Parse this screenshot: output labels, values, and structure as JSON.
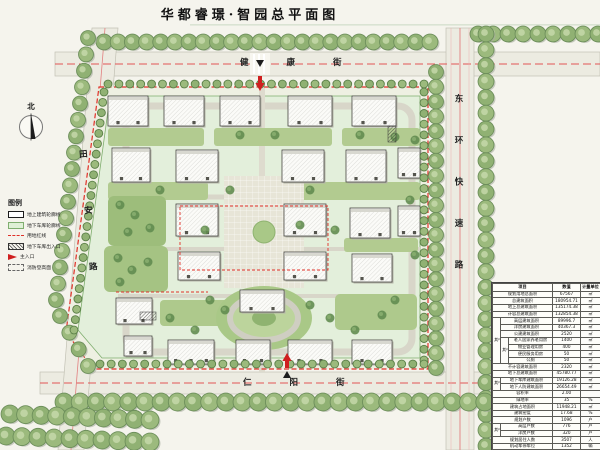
{
  "title": "华都睿璟·智园总平面图",
  "north_arrow_label": "北",
  "streets": {
    "north": "健康街",
    "south": "仁阳街",
    "west": "田安路",
    "east": "东环快速路"
  },
  "colors": {
    "boundary_red": "#e03028",
    "garage_green": "#dff0d6",
    "tree_green": "#9cba7d",
    "road_gray": "#ecebe1"
  },
  "legend": {
    "title": "图例",
    "items": [
      {
        "symbol": "building-outline",
        "label": "地上建筑轮廓线"
      },
      {
        "symbol": "garage-outline",
        "label": "地下车库轮廓线"
      },
      {
        "symbol": "red-line",
        "label": "用地红线"
      },
      {
        "symbol": "garage-entrance",
        "label": "地下车库出入口"
      },
      {
        "symbol": "main-entrance",
        "label": "主入口"
      },
      {
        "symbol": "fire-area",
        "label": "消防登高面"
      }
    ]
  },
  "table": {
    "headers": [
      "项目",
      "数值",
      "计量单位"
    ],
    "rows": [
      {
        "label": "规划用地总面积",
        "value": "67567",
        "unit": "㎡"
      },
      {
        "label": "总建筑面积",
        "value": "180954.71",
        "unit": "㎡"
      },
      {
        "label": "地上总建筑面积",
        "value": "135174.38",
        "unit": "㎡"
      },
      {
        "label": "计容总建筑面积",
        "value": "132854.38",
        "unit": "㎡"
      },
      {
        "group": "其中",
        "label": "高层建筑面积",
        "value": "89996.7",
        "unit": "㎡"
      },
      {
        "group": "其中",
        "label": "洋房建筑面积",
        "value": "40367.3",
        "unit": "㎡"
      },
      {
        "group": "其中",
        "label": "公建建筑面积",
        "value": "2520",
        "unit": "㎡"
      },
      {
        "group": "其中",
        "group2": "其中",
        "label": "老人居家养老用房",
        "value": "1400",
        "unit": "㎡"
      },
      {
        "group": "其中",
        "group2": "其中",
        "label": "物业管理用房",
        "value": "400",
        "unit": "㎡"
      },
      {
        "group": "其中",
        "group2": "其中",
        "label": "便民服务用房",
        "value": "50",
        "unit": "㎡"
      },
      {
        "group": "其中",
        "group2": "其中",
        "label": "公厕",
        "value": "50",
        "unit": "㎡"
      },
      {
        "label": "不计容建筑面积",
        "value": "2320",
        "unit": "㎡"
      },
      {
        "label": "地下总建筑面积",
        "value": "45780.77",
        "unit": "㎡"
      },
      {
        "group": "其中",
        "label": "地下车库建筑面积",
        "value": "19126.28",
        "unit": "㎡"
      },
      {
        "group": "其中",
        "label": "地下人防建筑面积",
        "value": "26654.49",
        "unit": "㎡"
      },
      {
        "label": "容积率",
        "value": "2.00",
        "unit": ""
      },
      {
        "label": "绿地率",
        "value": "35",
        "unit": "%"
      },
      {
        "label": "建筑占地面积",
        "value": "11948.21",
        "unit": "㎡"
      },
      {
        "label": "建筑密度",
        "value": "17.68",
        "unit": "%"
      },
      {
        "label": "规划户数",
        "value": "1096",
        "unit": "户"
      },
      {
        "group": "其中",
        "label": "高层户数",
        "value": "776",
        "unit": "户"
      },
      {
        "group": "其中",
        "label": "洋房户数",
        "value": "320",
        "unit": "户"
      },
      {
        "label": "规划居住人数",
        "value": "3507",
        "unit": "人"
      },
      {
        "label": "机动车停车位",
        "value": "1352",
        "unit": "辆"
      },
      {
        "label": "非机动车停车位",
        "value": "2190",
        "unit": "辆"
      }
    ]
  }
}
